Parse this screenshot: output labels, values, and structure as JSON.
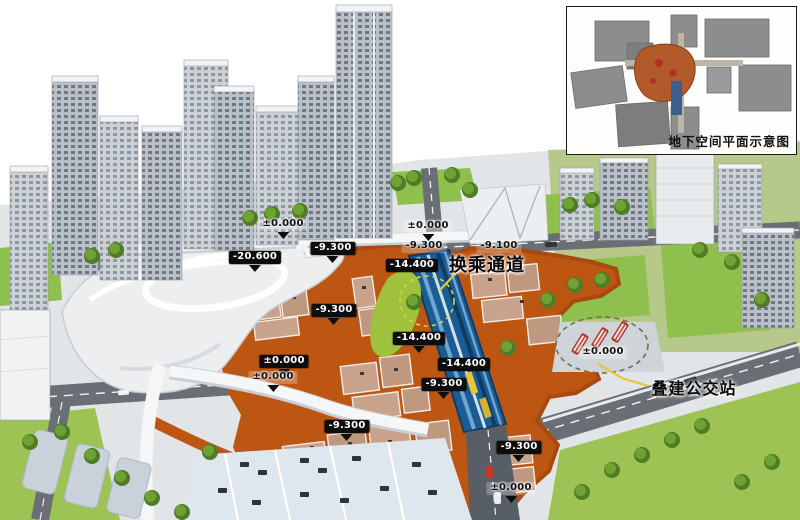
{
  "inset": {
    "caption": "地下空间平面示意图"
  },
  "callouts": {
    "transfer_passage": "换乘通道",
    "bus_station": "叠建公交站"
  },
  "elevations": [
    {
      "text": "-20.600"
    },
    {
      "text": "-9.300"
    },
    {
      "text": "-9.300"
    },
    {
      "text": "-9.100"
    },
    {
      "text": "±0.000"
    },
    {
      "text": "±0.000"
    },
    {
      "text": "-9.300"
    },
    {
      "text": "-14.400"
    },
    {
      "text": "-14.400"
    },
    {
      "text": "-9.300"
    },
    {
      "text": "±0.000"
    },
    {
      "text": "±0.000"
    },
    {
      "text": "-9.300"
    },
    {
      "text": "-9.300"
    },
    {
      "text": "±0.000"
    },
    {
      "text": "±0.000"
    },
    {
      "text": "-14.400"
    }
  ],
  "colors": {
    "underground_orange": "#bd5513",
    "station_blue": "#1c5c94",
    "lawn_green": "#8fbf4d",
    "road_gray": "#6a6f76",
    "highlight_yellow": "#e8c53a",
    "bus_red": "#b3332a",
    "label_black": "#0d0d0d"
  }
}
